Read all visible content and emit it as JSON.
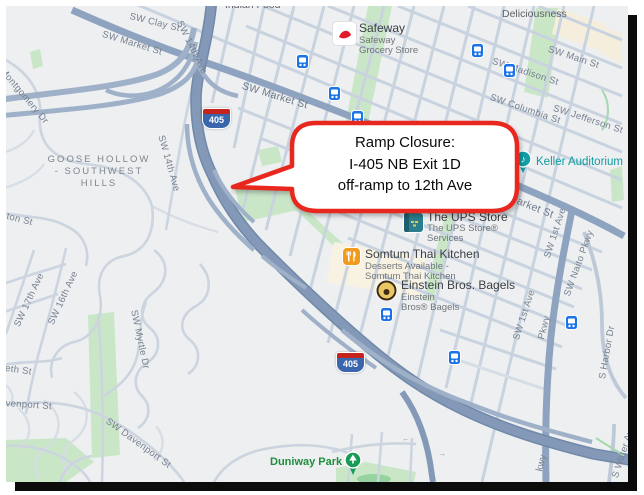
{
  "callout": {
    "line1": "Ramp Closure:",
    "line2": "I-405 NB Exit 1D",
    "line3": "off-ramp to 12th Ave"
  },
  "shield": {
    "number": "405"
  },
  "neighborhood": {
    "line1": "GOOSE HOLLOW",
    "line2": "- SOUTHWEST",
    "line3": "HILLS"
  },
  "streets": {
    "clay": "SW Clay St",
    "market": "SW Market St",
    "columbia": "SW Columbia St",
    "madison": "SW Madison St",
    "main": "SW Main St",
    "jefferson": "SW Jefferson St",
    "ave14": "SW 14th Ave",
    "ave16": "SW 16th Ave",
    "ave17": "SW 17th Ave",
    "ave1": "SW 1st Ave",
    "naito": "SW Naito Pkwy",
    "naito_frag": "Pkwy",
    "naito_frag2": "kwy",
    "harbor": "S Harbor Dr",
    "water": "S Water Ave",
    "montgomery": "Montgomery Dr",
    "myrtle": "SW Myrtle Dr",
    "davenport": "SW Davenport St",
    "davenport_frag": "venport St",
    "elizabeth_frag": "eth St",
    "clifton_frag": "ton St"
  },
  "pois": {
    "indian_food": "Indian Food",
    "deliciousness": "Deliciousness",
    "safeway": {
      "title": "Safeway",
      "sub1": "Safeway",
      "sub2": "Grocery Store"
    },
    "keller": "Keller Auditorium",
    "ups": {
      "title": "The UPS Store",
      "sub1": "The UPS Store®",
      "sub2": "Services"
    },
    "somtum": {
      "title": "Somtum Thai Kitchen",
      "sub1": "Desserts Available -",
      "sub2": "Somtum Thai Kitchen"
    },
    "einstein": {
      "title": "Einstein Bros. Bagels",
      "sub1": "Einstein",
      "sub2": "Bros® Bagels"
    },
    "duniway": "Duniway Park"
  },
  "colors": {
    "callout_red": "#e8281e",
    "freeway": "#8499b7",
    "route": "#8ea3bf",
    "park_green": "#c9e7c7",
    "transit_blue": "#1a73e8",
    "keller_teal": "#0f9ba3",
    "duniway_green": "#1e8e3e",
    "shield_blue": "#3a66ad",
    "shield_red": "#c5231d"
  }
}
